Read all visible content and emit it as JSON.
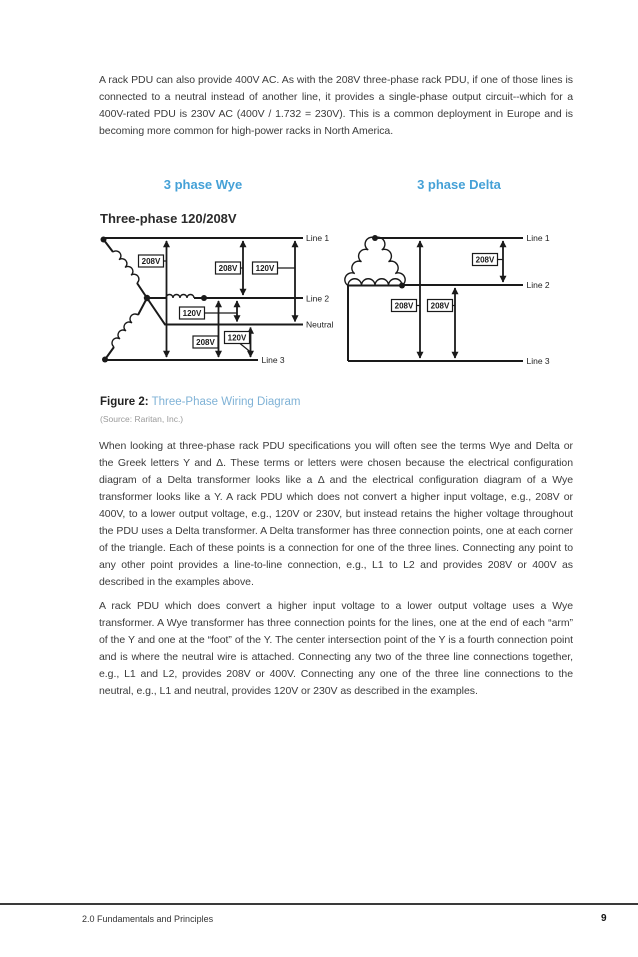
{
  "content": {
    "intro": "A rack PDU can also provide 400V AC. As with the 208V three-phase rack PDU, if one of those lines is connected to a neutral instead of another line, it provides a single-phase output circuit--which for a 400V-rated PDU is 230V AC (400V / 1.732 = 230V). This is a common deployment in Europe and is becoming more common for high-power racks in North America.",
    "paragraph_delta": "When looking at three-phase rack PDU specifications you will often see the terms Wye and Delta or the Greek letters Y and Δ. These terms or letters were chosen because the electrical configuration diagram of a Delta transformer looks like a Δ and the electrical configuration diagram of a Wye transformer looks like a Y. A rack PDU which does not convert a higher input voltage, e.g., 208V or 400V, to a lower output voltage, e.g., 120V or 230V, but instead retains the higher voltage throughout the PDU uses a Delta transformer. A Delta transformer has three connection points, one at each corner of the triangle. Each of these points is a connection for one of the three lines. Connecting any point to any other point provides a line-to-line connection, e.g., L1 to L2 and provides 208V or 400V as described in the examples above.",
    "paragraph_wye": "A rack PDU which does convert a higher input voltage to a lower output voltage uses a Wye transformer. A Wye transformer has three connection points for the lines, one at the end of each “arm” of the Y and one at the “foot” of the Y. The center intersection point of the Y is a fourth connection point and is where the neutral wire is attached. Connecting any two of the three line connections together, e.g., L1 and L2, provides 208V or 400V. Connecting any one of the three line connections to the neutral, e.g., L1 and neutral, provides 120V or 230V as described in the examples."
  },
  "figure": {
    "wye_heading": "3 phase Wye",
    "delta_heading": "3 phase Delta",
    "subtitle": "Three-phase 120/208V",
    "caption_label": "Figure 2:",
    "caption_title": "Three-Phase Wiring Diagram",
    "source": "(Source: Raritan, Inc.)",
    "wye": {
      "line_labels": [
        "Line 1",
        "Line 2",
        "Neutral",
        "Line 3"
      ],
      "voltage_labels": [
        "208V",
        "208V",
        "120V",
        "120V",
        "208V",
        "120V"
      ]
    },
    "delta": {
      "line_labels": [
        "Line 1",
        "Line 2",
        "Line 3"
      ],
      "voltage_labels": [
        "208V",
        "208V",
        "208V"
      ]
    }
  },
  "footer": {
    "section": "2.0 Fundamentals and Principles",
    "page_number": "9"
  },
  "colors": {
    "heading_blue": "#45a1d7",
    "caption_blue": "#7fb2d6"
  }
}
